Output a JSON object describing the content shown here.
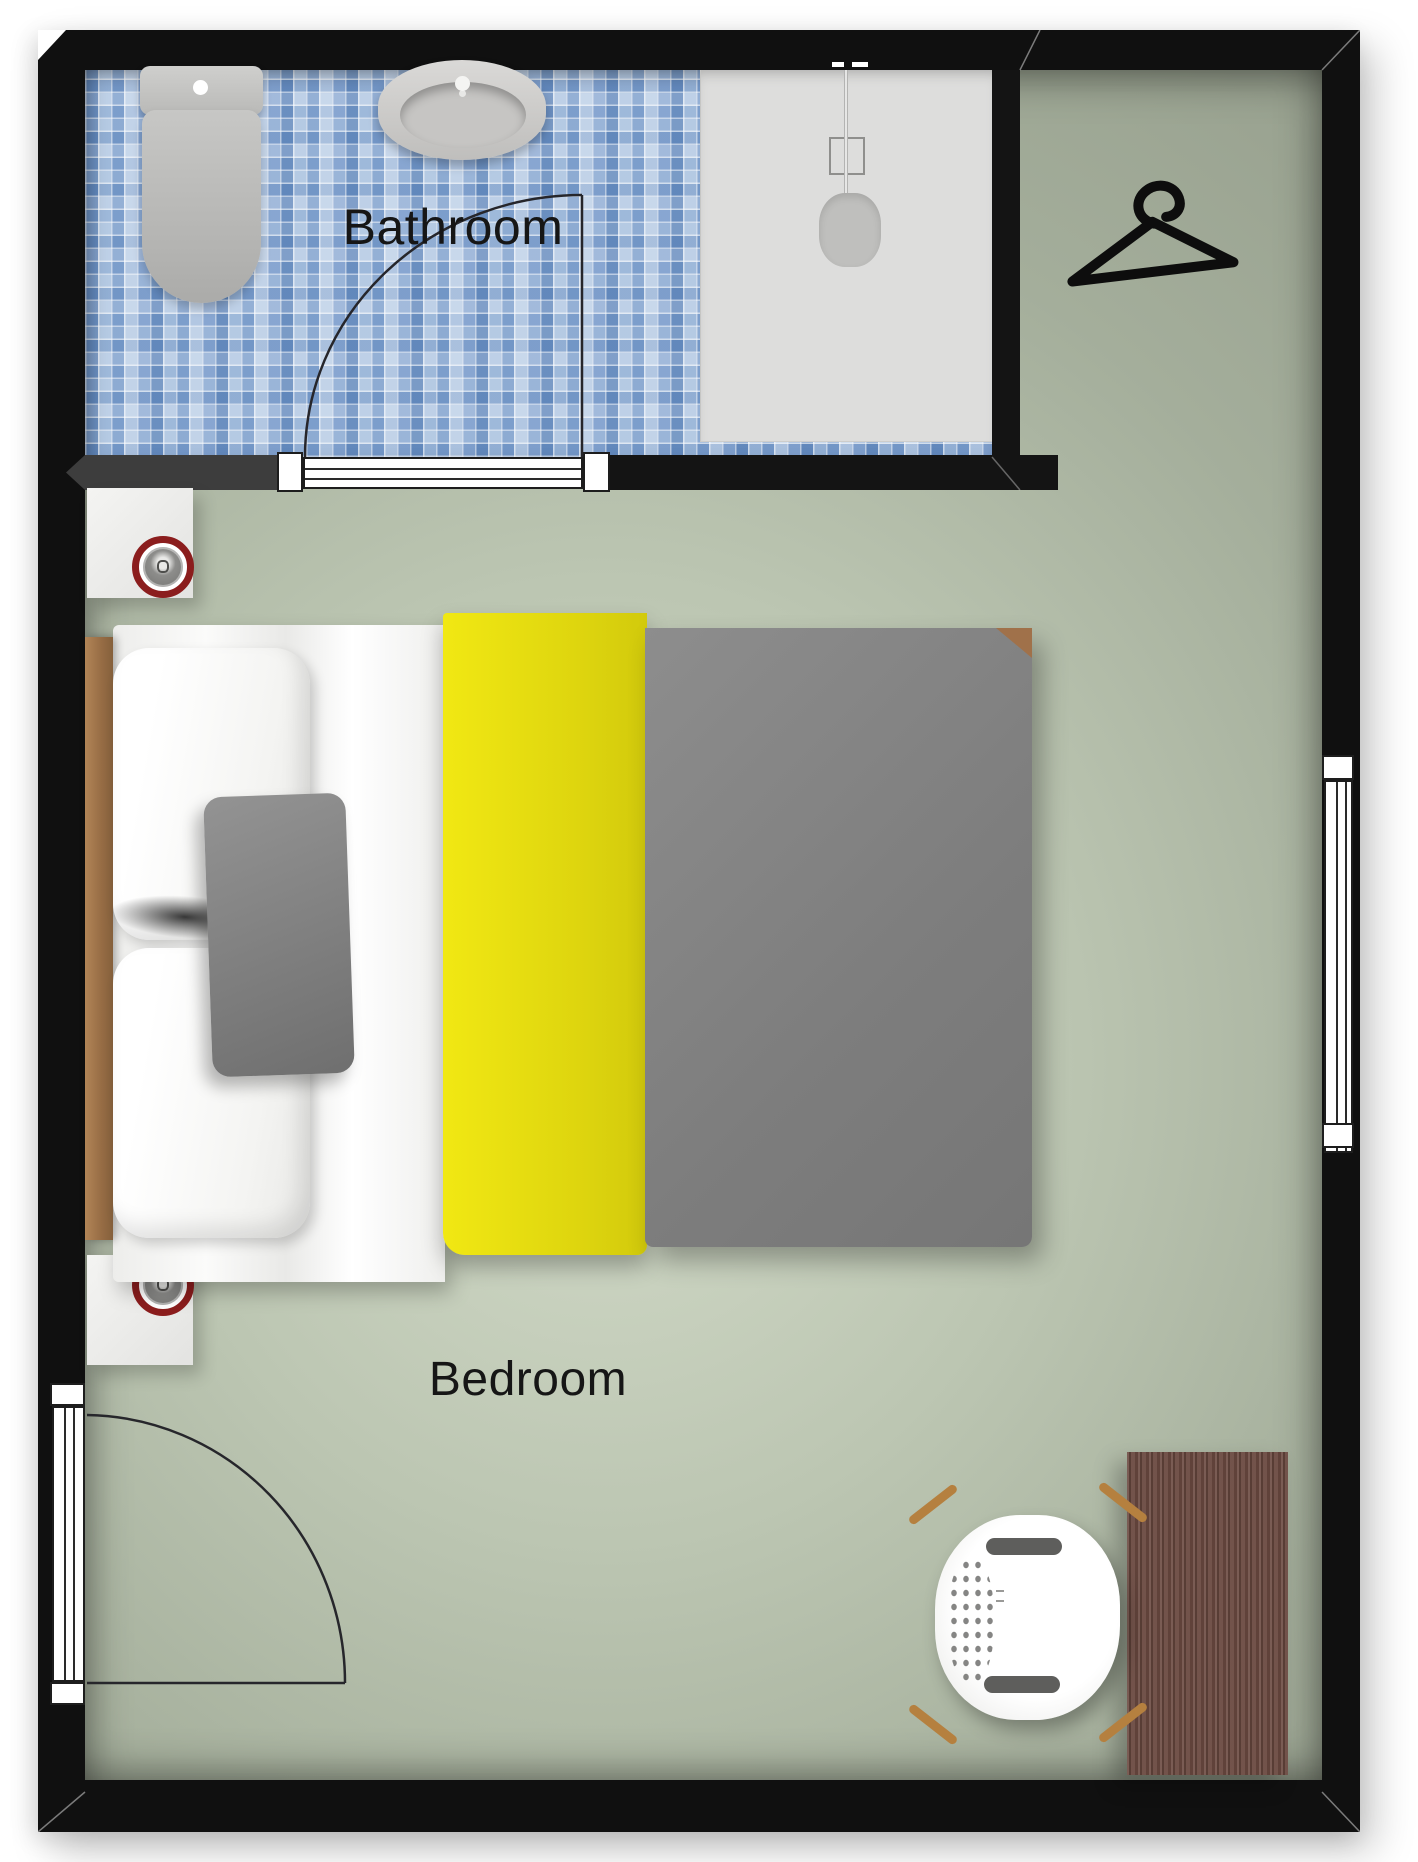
{
  "rooms": {
    "bathroom": {
      "label": "Bathroom"
    },
    "bedroom": {
      "label": "Bedroom"
    }
  },
  "colors": {
    "wall": "#141414",
    "wall_gray_segment": "#3d3d3d",
    "floor_green": "#aab4a1",
    "tile_blue": "#7fa6d4",
    "shower_tray": "#dddddc",
    "blanket_yellow": "#e8df10",
    "duvet_gray": "#848484",
    "wood_desk": "#6b4a41",
    "wood_headboard": "#9a7249",
    "lamp_ring_red": "#8b1d1d",
    "chair_leg_wood": "#b5803f"
  },
  "furniture_icons": [
    "toilet-icon",
    "sink-icon",
    "shower-icon",
    "clothes-hanger-icon",
    "nightstand",
    "ceiling-lamp",
    "double-bed",
    "pillow",
    "cushion",
    "yellow-blanket",
    "gray-duvet",
    "desk",
    "chair"
  ],
  "openings": [
    "bathroom-door",
    "entry-door",
    "right-wall-window"
  ]
}
